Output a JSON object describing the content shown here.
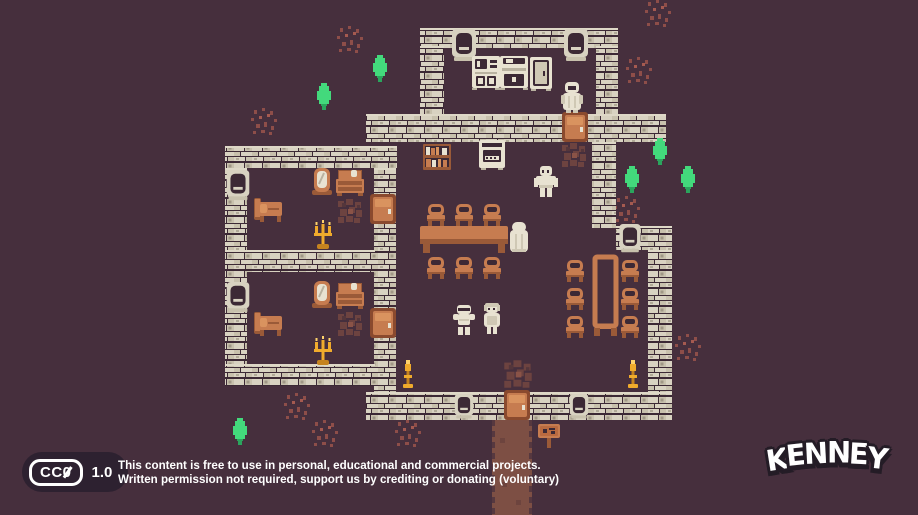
{
  "scene": {
    "background": "#462f3d",
    "palette": {
      "wall_brick": "#d8d2c1",
      "wall_brick_alt": "#c8c1ad",
      "wall_mortar": "#3c2935",
      "wood_orange": "#c67c50",
      "wood_orange_dark": "#9a5a38",
      "wood_orange_light": "#d9935f",
      "cream": "#e8e2d1",
      "cream_shade": "#cfc8b4",
      "gold": "#f0ab2c",
      "gold_light": "#ffd36b",
      "gold_dark": "#c5831f",
      "tree_green": "#43d97c",
      "tree_green_dark": "#2aa55d",
      "dirt": "#6d4340",
      "path": "#7d4f44",
      "path_edge": "#56383f",
      "sprout": "#8e4e49",
      "text": "#ffffff",
      "badge_bg": "#2d2130",
      "logo_outline": "#241c26"
    }
  },
  "map": {
    "tile_size": 18,
    "walls": [
      {
        "x": 420,
        "y": 28,
        "w": 198,
        "h": 20
      },
      {
        "x": 420,
        "y": 46,
        "w": 24,
        "h": 70
      },
      {
        "x": 596,
        "y": 46,
        "w": 22,
        "h": 70
      },
      {
        "x": 366,
        "y": 114,
        "w": 300,
        "h": 28
      },
      {
        "x": 225,
        "y": 146,
        "w": 172,
        "h": 22
      },
      {
        "x": 225,
        "y": 168,
        "w": 22,
        "h": 218
      },
      {
        "x": 374,
        "y": 168,
        "w": 22,
        "h": 226
      },
      {
        "x": 225,
        "y": 250,
        "w": 150,
        "h": 22
      },
      {
        "x": 225,
        "y": 364,
        "w": 150,
        "h": 22
      },
      {
        "x": 592,
        "y": 142,
        "w": 24,
        "h": 86
      },
      {
        "x": 616,
        "y": 226,
        "w": 56,
        "h": 24
      },
      {
        "x": 648,
        "y": 250,
        "w": 24,
        "h": 144
      },
      {
        "x": 366,
        "y": 392,
        "w": 306,
        "h": 28
      }
    ],
    "windows": [
      {
        "x": 452,
        "y": 28,
        "h": 36
      },
      {
        "x": 564,
        "y": 28,
        "h": 36
      },
      {
        "x": 226,
        "y": 170,
        "h": 32
      },
      {
        "x": 226,
        "y": 282,
        "h": 32
      },
      {
        "x": 618,
        "y": 224,
        "h": 30
      },
      {
        "x": 452,
        "y": 394,
        "h": 26
      },
      {
        "x": 567,
        "y": 394,
        "h": 26
      }
    ],
    "doors": [
      {
        "x": 562,
        "y": 112
      },
      {
        "x": 370,
        "y": 194
      },
      {
        "x": 370,
        "y": 308
      },
      {
        "x": 504,
        "y": 390
      }
    ],
    "furniture": [
      {
        "t": "bed",
        "x": 254,
        "y": 196
      },
      {
        "t": "bed",
        "x": 254,
        "y": 310
      },
      {
        "t": "mirror",
        "x": 309,
        "y": 168
      },
      {
        "t": "mirror",
        "x": 309,
        "y": 281
      },
      {
        "t": "dresser",
        "x": 336,
        "y": 170
      },
      {
        "t": "dresser",
        "x": 336,
        "y": 283
      },
      {
        "t": "bookshelf",
        "x": 423,
        "y": 144
      },
      {
        "t": "stove",
        "x": 479,
        "y": 140
      },
      {
        "t": "hutch",
        "x": 472,
        "y": 56
      },
      {
        "t": "counter",
        "x": 500,
        "y": 56
      },
      {
        "t": "cupboard",
        "x": 530,
        "y": 57
      },
      {
        "t": "tableh",
        "x": 420,
        "y": 226
      },
      {
        "t": "tablev",
        "x": 592,
        "y": 254
      },
      {
        "t": "chair",
        "x": 426,
        "y": 204
      },
      {
        "t": "chair",
        "x": 454,
        "y": 204
      },
      {
        "t": "chair",
        "x": 482,
        "y": 204
      },
      {
        "t": "chair",
        "x": 426,
        "y": 257
      },
      {
        "t": "chair",
        "x": 454,
        "y": 257
      },
      {
        "t": "chair",
        "x": 482,
        "y": 257
      },
      {
        "t": "chair",
        "x": 565,
        "y": 260
      },
      {
        "t": "chair",
        "x": 565,
        "y": 288
      },
      {
        "t": "chair",
        "x": 565,
        "y": 316
      },
      {
        "t": "chair",
        "x": 620,
        "y": 260
      },
      {
        "t": "chair",
        "x": 620,
        "y": 288
      },
      {
        "t": "chair",
        "x": 620,
        "y": 316
      },
      {
        "t": "candelabra",
        "x": 313,
        "y": 220
      },
      {
        "t": "candelabra",
        "x": 313,
        "y": 336
      },
      {
        "t": "candle",
        "x": 400,
        "y": 360
      },
      {
        "t": "candle",
        "x": 625,
        "y": 360
      },
      {
        "t": "sign",
        "x": 538,
        "y": 424
      }
    ],
    "characters": [
      {
        "t": "monk",
        "x": 560,
        "y": 82
      },
      {
        "t": "villager",
        "x": 534,
        "y": 166
      },
      {
        "t": "hooded",
        "x": 507,
        "y": 222
      },
      {
        "t": "knight",
        "x": 452,
        "y": 304
      },
      {
        "t": "woman",
        "x": 480,
        "y": 303
      }
    ],
    "trees": [
      {
        "x": 371,
        "y": 55
      },
      {
        "x": 315,
        "y": 83
      },
      {
        "x": 651,
        "y": 138
      },
      {
        "x": 623,
        "y": 166
      },
      {
        "x": 679,
        "y": 166
      },
      {
        "x": 231,
        "y": 418
      }
    ],
    "sprouts": [
      {
        "x": 336,
        "y": 26
      },
      {
        "x": 250,
        "y": 108
      },
      {
        "x": 644,
        "y": 0
      },
      {
        "x": 625,
        "y": 57
      },
      {
        "x": 613,
        "y": 196
      },
      {
        "x": 283,
        "y": 393
      },
      {
        "x": 311,
        "y": 420
      },
      {
        "x": 394,
        "y": 420
      },
      {
        "x": 674,
        "y": 334
      }
    ],
    "dirt": [
      {
        "x": 336,
        "y": 197
      },
      {
        "x": 336,
        "y": 310
      },
      {
        "x": 560,
        "y": 141
      },
      {
        "x": 502,
        "y": 355,
        "w": 32,
        "h": 38
      }
    ],
    "path": {
      "x": 492,
      "y": 420,
      "w": 40,
      "h": 95
    }
  },
  "footer": {
    "badge": {
      "cc_prefix": "CC",
      "zero": "0",
      "version": "1.0"
    },
    "license_line1": "This content is free to use in personal, educational and commercial projects.",
    "license_line2": "Written permission not required, support us by crediting or donating (voluntary)"
  },
  "logo": {
    "text": "KENNEY"
  }
}
